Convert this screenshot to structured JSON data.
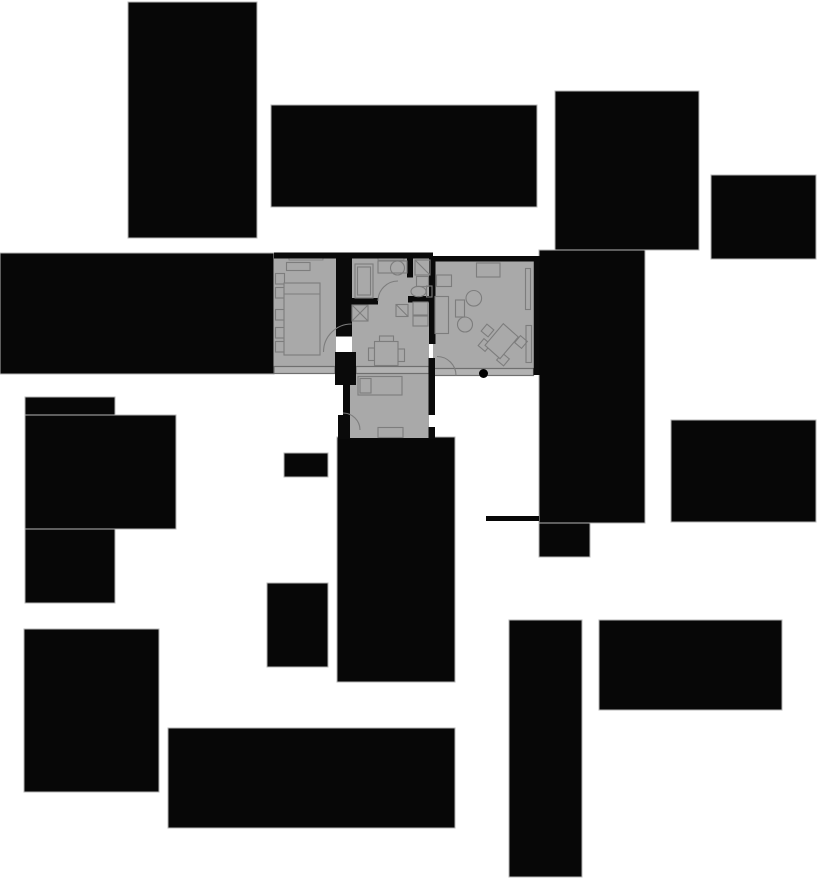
{
  "canvas": {
    "width": 818,
    "height": 879,
    "background": "#ffffff"
  },
  "colors": {
    "building_fill": "#070707",
    "building_stroke": "#b5b5b5",
    "floor_fill": "#a9a9a9",
    "wall_fill": "#0a0a0a",
    "furniture_stroke": "#7d7d7d",
    "window_fill": "#b2b2b2",
    "window_stroke": "#6f6f6f",
    "entry_dot": "#000000"
  },
  "layers": [
    {
      "name": "buildings",
      "style": {
        "f": "#070707",
        "s": "#b5b5b5",
        "sw": 1
      },
      "shapes": [
        {
          "t": "rect",
          "n": "building-top-left",
          "x": 128,
          "y": 2,
          "w": 129,
          "h": 236
        },
        {
          "t": "rect",
          "n": "building-top-center",
          "x": 271,
          "y": 105,
          "w": 266,
          "h": 102
        },
        {
          "t": "rect",
          "n": "building-top-right",
          "x": 555,
          "y": 91,
          "w": 144,
          "h": 159
        },
        {
          "t": "rect",
          "n": "building-east-column",
          "x": 539,
          "y": 250,
          "w": 106,
          "h": 273
        },
        {
          "t": "rect",
          "n": "building-east-column-foot",
          "x": 539,
          "y": 523,
          "w": 51,
          "h": 34
        },
        {
          "t": "rect",
          "n": "building-east-upper",
          "x": 711,
          "y": 175,
          "w": 105,
          "h": 84
        },
        {
          "t": "rect",
          "n": "building-west-band",
          "x": 0,
          "y": 253,
          "w": 274,
          "h": 121
        },
        {
          "t": "rect",
          "n": "building-southwest-tall",
          "x": 25,
          "y": 397,
          "w": 90,
          "h": 206
        },
        {
          "t": "rect",
          "n": "building-southwest-wide",
          "x": 25,
          "y": 415,
          "w": 151,
          "h": 114
        },
        {
          "t": "rect",
          "n": "building-small-center",
          "x": 284,
          "y": 453,
          "w": 44,
          "h": 24
        },
        {
          "t": "rect",
          "n": "building-center-south",
          "x": 337,
          "y": 437,
          "w": 118,
          "h": 245
        },
        {
          "t": "rect",
          "n": "building-mid-south",
          "x": 267,
          "y": 583,
          "w": 61,
          "h": 84
        },
        {
          "t": "rect",
          "n": "building-southwest-low",
          "x": 24,
          "y": 629,
          "w": 135,
          "h": 163
        },
        {
          "t": "rect",
          "n": "building-south-wide",
          "x": 168,
          "y": 728,
          "w": 287,
          "h": 100
        },
        {
          "t": "rect",
          "n": "wall-fragment-east",
          "x": 486,
          "y": 516,
          "w": 53,
          "h": 5,
          "s": "none"
        },
        {
          "t": "rect",
          "n": "building-southeast-upper",
          "x": 671,
          "y": 420,
          "w": 145,
          "h": 102
        },
        {
          "t": "rect",
          "n": "building-southeast-tall",
          "x": 509,
          "y": 620,
          "w": 73,
          "h": 257
        },
        {
          "t": "rect",
          "n": "building-southeast-wide",
          "x": 599,
          "y": 620,
          "w": 183,
          "h": 90
        }
      ]
    },
    {
      "name": "floor-rooms",
      "style": {
        "f": "#a9a9a9",
        "s": "none",
        "sw": 0
      },
      "shapes": [
        {
          "t": "rect",
          "n": "room-bedroom-1",
          "x": 274,
          "y": 255,
          "w": 62,
          "h": 112
        },
        {
          "t": "rect",
          "n": "room-kitchen-wc",
          "x": 352,
          "y": 256,
          "w": 81,
          "h": 42
        },
        {
          "t": "rect",
          "n": "room-hall",
          "x": 352,
          "y": 296,
          "w": 77,
          "h": 71
        },
        {
          "t": "rect",
          "n": "room-bedroom-2",
          "x": 350,
          "y": 367,
          "w": 79,
          "h": 71
        },
        {
          "t": "rect",
          "n": "room-living",
          "x": 433,
          "y": 261,
          "w": 100,
          "h": 107
        }
      ]
    },
    {
      "name": "windows",
      "style": {
        "f": "#b2b2b2",
        "s": "#6f6f6f",
        "sw": 1.2
      },
      "shapes": [
        {
          "t": "rect",
          "n": "window-band-bedroom1",
          "x": 274,
          "y": 366.5,
          "w": 61,
          "h": 7
        },
        {
          "t": "rect",
          "n": "window-band-hall",
          "x": 356,
          "y": 366.5,
          "w": 73,
          "h": 7
        },
        {
          "t": "rect",
          "n": "window-band-living",
          "x": 433,
          "y": 368.5,
          "w": 100.5,
          "h": 7
        },
        {
          "t": "rect",
          "n": "window-notch-bedroom1",
          "x": 289,
          "y": 254.5,
          "w": 34,
          "h": 5.5,
          "f": "#adadad",
          "s": "#7d7d7d",
          "sw": 0.8
        },
        {
          "t": "rect",
          "n": "window-notch-kitchen",
          "x": 378,
          "y": 254.5,
          "w": 26,
          "h": 5.5,
          "f": "#adadad",
          "s": "#7d7d7d",
          "sw": 0.8
        }
      ]
    },
    {
      "name": "walls",
      "style": {
        "f": "#0a0a0a",
        "s": "none",
        "sw": 0
      },
      "shapes": [
        {
          "t": "rect",
          "n": "wall-top-west",
          "x": 274,
          "y": 252.5,
          "w": 159,
          "h": 6
        },
        {
          "t": "rect",
          "n": "wall-top-living",
          "x": 429,
          "y": 256,
          "w": 111,
          "h": 5.5
        },
        {
          "t": "rect",
          "n": "wall-bedroom1-east",
          "x": 336,
          "y": 252.5,
          "w": 16,
          "h": 84
        },
        {
          "t": "rect",
          "n": "wall-hall-lower-a",
          "x": 335,
          "y": 352,
          "w": 21,
          "h": 33
        },
        {
          "t": "rect",
          "n": "wall-hall-lower-b",
          "x": 343,
          "y": 385,
          "w": 7,
          "h": 30
        },
        {
          "t": "rect",
          "n": "wall-bedroom2-west",
          "x": 338,
          "y": 415,
          "w": 12,
          "h": 24
        },
        {
          "t": "rect",
          "n": "wall-kitchen-south",
          "x": 352,
          "y": 298,
          "w": 26,
          "h": 6.5
        },
        {
          "t": "rect",
          "n": "wall-wc-south",
          "x": 408,
          "y": 296,
          "w": 22,
          "h": 6.5
        },
        {
          "t": "rect",
          "n": "wall-kitchen-wc-divider",
          "x": 407,
          "y": 252.5,
          "w": 6,
          "h": 25
        },
        {
          "t": "rect",
          "n": "wall-hall-living",
          "x": 429,
          "y": 256,
          "w": 6.5,
          "h": 88
        },
        {
          "t": "rect",
          "n": "wall-bedroom2-east-a",
          "x": 428.5,
          "y": 358,
          "w": 6.5,
          "h": 57
        },
        {
          "t": "rect",
          "n": "wall-bedroom2-east-b",
          "x": 428.5,
          "y": 427,
          "w": 6.5,
          "h": 12
        },
        {
          "t": "rect",
          "n": "wall-living-east",
          "x": 533.5,
          "y": 256,
          "w": 6,
          "h": 119
        }
      ]
    },
    {
      "name": "furniture",
      "style": {
        "f": "none",
        "s": "#7d7d7d",
        "sw": 1.1
      },
      "shapes": [
        {
          "t": "rect",
          "n": "bedroom1-dresser",
          "x": 286.5,
          "y": 262.5,
          "w": 23.5,
          "h": 8
        },
        {
          "t": "rect",
          "n": "bedroom1-shelf-1",
          "x": 275.5,
          "y": 273.5,
          "w": 9,
          "h": 10.5
        },
        {
          "t": "rect",
          "n": "bedroom1-shelf-2",
          "x": 275.5,
          "y": 287.5,
          "w": 9,
          "h": 10.5
        },
        {
          "t": "rect",
          "n": "bedroom1-shelf-3",
          "x": 275.5,
          "y": 309.5,
          "w": 9,
          "h": 10.5
        },
        {
          "t": "rect",
          "n": "bedroom1-shelf-4",
          "x": 275.5,
          "y": 327.5,
          "w": 9,
          "h": 10.5
        },
        {
          "t": "rect",
          "n": "bedroom1-shelf-5",
          "x": 275.5,
          "y": 341.5,
          "w": 9,
          "h": 10.5
        },
        {
          "t": "rect",
          "n": "bedroom1-bed",
          "x": 284,
          "y": 283,
          "w": 36,
          "h": 72,
          "f": "#a9a9a9"
        },
        {
          "t": "line",
          "n": "bedroom1-bed-pillow-line",
          "x1": 284,
          "y1": 294,
          "x2": 320,
          "y2": 294
        },
        {
          "t": "rect",
          "n": "kitchen-closet",
          "x": 355,
          "y": 264,
          "w": 18,
          "h": 34
        },
        {
          "t": "rect",
          "n": "kitchen-closet-inner",
          "x": 357.5,
          "y": 267,
          "w": 13,
          "h": 28
        },
        {
          "t": "rect",
          "n": "kitchen-counter",
          "x": 378,
          "y": 261,
          "w": 29,
          "h": 12
        },
        {
          "t": "circle",
          "n": "kitchen-sink",
          "cx": 397.5,
          "cy": 268,
          "r": 7
        },
        {
          "t": "rect",
          "n": "wc-corner-unit",
          "x": 415,
          "y": 260,
          "w": 15,
          "h": 15
        },
        {
          "t": "line",
          "n": "wc-corner-diagonal",
          "x1": 415,
          "y1": 260,
          "x2": 430,
          "y2": 275
        },
        {
          "t": "rect",
          "n": "wc-basin",
          "x": 416.5,
          "y": 276.5,
          "w": 12,
          "h": 10
        },
        {
          "t": "ellipse",
          "n": "wc-toilet-bowl",
          "cx": 418.5,
          "cy": 291.5,
          "rx": 7.5,
          "ry": 5.2
        },
        {
          "t": "rect",
          "n": "wc-toilet-tank",
          "x": 426.5,
          "y": 286,
          "w": 5.5,
          "h": 11
        },
        {
          "t": "rect",
          "n": "hall-shaft-box",
          "x": 352,
          "y": 305,
          "w": 16,
          "h": 16
        },
        {
          "t": "line",
          "n": "hall-shaft-x1",
          "x1": 352,
          "y1": 305,
          "x2": 368,
          "y2": 321
        },
        {
          "t": "line",
          "n": "hall-shaft-x2",
          "x1": 352,
          "y1": 321,
          "x2": 368,
          "y2": 305
        },
        {
          "t": "rect",
          "n": "hall-diag-box",
          "x": 396,
          "y": 304.5,
          "w": 12,
          "h": 12
        },
        {
          "t": "line",
          "n": "hall-diag-line",
          "x1": 396,
          "y1": 304.5,
          "x2": 408,
          "y2": 316.5
        },
        {
          "t": "rect",
          "n": "hall-cabinet-1",
          "x": 413,
          "y": 302,
          "w": 15,
          "h": 13
        },
        {
          "t": "rect",
          "n": "hall-cabinet-2",
          "x": 413,
          "y": 316,
          "w": 15,
          "h": 10
        },
        {
          "t": "rect",
          "n": "hall-chair-top",
          "x": 379.5,
          "y": 336,
          "w": 14,
          "h": 5.5
        },
        {
          "t": "rect",
          "n": "hall-chair-left",
          "x": 368.5,
          "y": 348,
          "w": 6,
          "h": 12.5
        },
        {
          "t": "rect",
          "n": "hall-chair-right",
          "x": 398,
          "y": 349,
          "w": 6.5,
          "h": 12.5
        },
        {
          "t": "rect",
          "n": "hall-dining-table",
          "x": 374.5,
          "y": 341.5,
          "w": 23.5,
          "h": 24,
          "f": "#a9a9a9"
        },
        {
          "t": "rect",
          "n": "bedroom2-bed",
          "x": 358,
          "y": 376.5,
          "w": 44,
          "h": 18.5,
          "f": "#a9a9a9"
        },
        {
          "t": "rect",
          "n": "bedroom2-pillow",
          "x": 360,
          "y": 378.5,
          "w": 11,
          "h": 14.5
        },
        {
          "t": "rect",
          "n": "bedroom2-dresser",
          "x": 378,
          "y": 427.5,
          "w": 25,
          "h": 10
        },
        {
          "t": "rect",
          "n": "living-sideboard",
          "x": 476.5,
          "y": 263,
          "w": 23.5,
          "h": 14
        },
        {
          "t": "rect",
          "n": "living-cabinet",
          "x": 436.5,
          "y": 275,
          "w": 15,
          "h": 11.5
        },
        {
          "t": "rect",
          "n": "living-sofa",
          "x": 435,
          "y": 296.5,
          "w": 13.5,
          "h": 37
        },
        {
          "t": "rect",
          "n": "living-side-unit",
          "x": 455.5,
          "y": 300,
          "w": 9,
          "h": 17
        },
        {
          "t": "circle",
          "n": "living-round-table-1",
          "cx": 473.8,
          "cy": 298.3,
          "r": 7.8
        },
        {
          "t": "circle",
          "n": "living-round-table-2",
          "cx": 465,
          "cy": 324.5,
          "r": 7.5
        },
        {
          "t": "rect",
          "n": "living-desk-chair-1",
          "x": 483,
          "y": 326,
          "w": 9,
          "h": 9,
          "tr": "rotate(40 487.5 330.5)"
        },
        {
          "t": "rect",
          "n": "living-desk-chair-2",
          "x": 480,
          "y": 340.5,
          "w": 9,
          "h": 9,
          "tr": "rotate(40 484.5 345)"
        },
        {
          "t": "rect",
          "n": "living-desk-chair-3",
          "x": 516.5,
          "y": 337.5,
          "w": 9,
          "h": 9,
          "tr": "rotate(40 521 342)"
        },
        {
          "t": "rect",
          "n": "living-desk-chair-4",
          "x": 498.5,
          "y": 355,
          "w": 9,
          "h": 9,
          "tr": "rotate(40 503 359.5)"
        },
        {
          "t": "polygon",
          "n": "living-desk",
          "pts": "503.3,323.7 518.3,337 500,358.7 485,345.3",
          "f": "#a9a9a9"
        },
        {
          "t": "rect",
          "n": "living-shelf-1",
          "x": 525.5,
          "y": 268.5,
          "w": 5,
          "h": 41
        },
        {
          "t": "rect",
          "n": "living-shelf-2",
          "x": 526,
          "y": 325.5,
          "w": 5.5,
          "h": 37
        }
      ]
    },
    {
      "name": "doors",
      "style": {
        "f": "none",
        "s": "#7d7d7d",
        "sw": 1.1
      },
      "shapes": [
        {
          "t": "path",
          "n": "door-arc-bedroom1",
          "d": "M 323.5 352 A 28 28 0 0 1 351.5 324"
        },
        {
          "t": "path",
          "n": "door-arc-kitchen",
          "d": "M 378 301 A 20 20 0 0 1 398 281"
        },
        {
          "t": "path",
          "n": "door-arc-entry",
          "d": "M 437 356.5 A 19 19 0 0 1 456 375.5"
        },
        {
          "t": "path",
          "n": "door-arc-bedroom2",
          "d": "M 343 413 A 17 17 0 0 1 360 430"
        }
      ]
    },
    {
      "name": "markers",
      "style": {
        "f": "#000000",
        "s": "none",
        "sw": 0
      },
      "shapes": [
        {
          "t": "circle",
          "n": "entry-dot",
          "cx": 483.5,
          "cy": 373.5,
          "r": 4.5
        }
      ]
    }
  ]
}
